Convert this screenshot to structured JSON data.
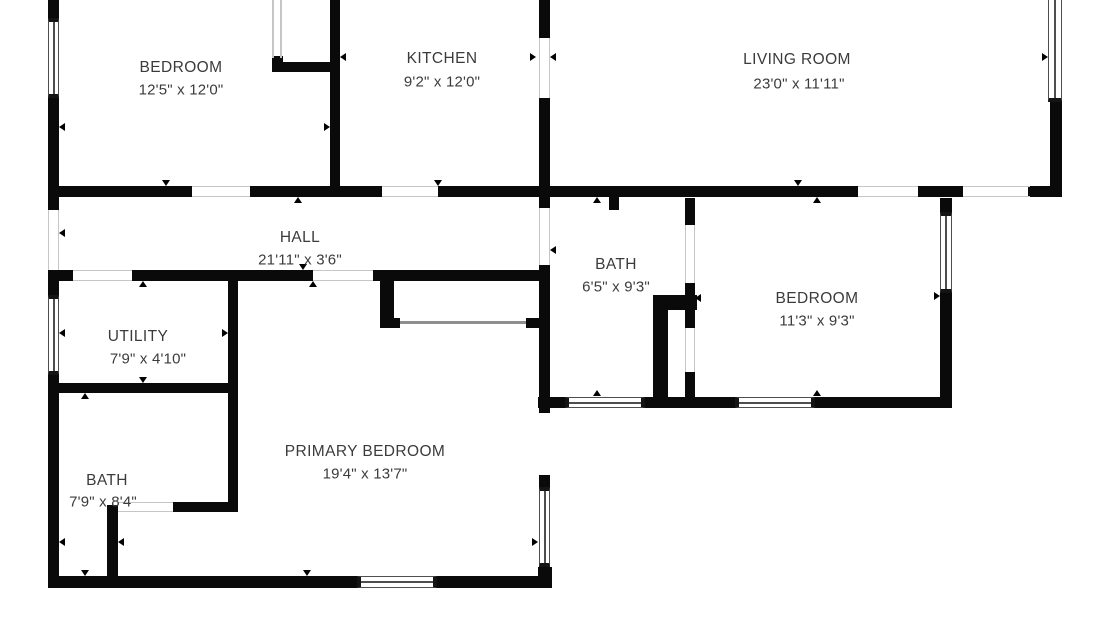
{
  "plan": {
    "title": "floor-plan",
    "rooms": [
      {
        "id": "bedroom-tl",
        "name": "BEDROOM",
        "dims": "12'5\" x 12'0\""
      },
      {
        "id": "kitchen",
        "name": "KITCHEN",
        "dims": "9'2\" x 12'0\""
      },
      {
        "id": "living-room",
        "name": "LIVING ROOM",
        "dims": "23'0\" x 11'11\""
      },
      {
        "id": "hall",
        "name": "HALL",
        "dims": "21'11\" x 3'6\""
      },
      {
        "id": "bath-mid",
        "name": "BATH",
        "dims": "6'5\" x 9'3\""
      },
      {
        "id": "bedroom-br",
        "name": "BEDROOM",
        "dims": "11'3\" x 9'3\""
      },
      {
        "id": "utility",
        "name": "UTILITY",
        "dims": "7'9\" x 4'10\""
      },
      {
        "id": "bath-bl",
        "name": "BATH",
        "dims": "7'9\" x 8'4\""
      },
      {
        "id": "primary-bedroom",
        "name": "PRIMARY BEDROOM",
        "dims": "19'4\" x 13'7\""
      }
    ],
    "colors": {
      "wall": "#0a0a0a",
      "text": "#3b3b3b",
      "opening_line": "#c6c6c6"
    }
  }
}
